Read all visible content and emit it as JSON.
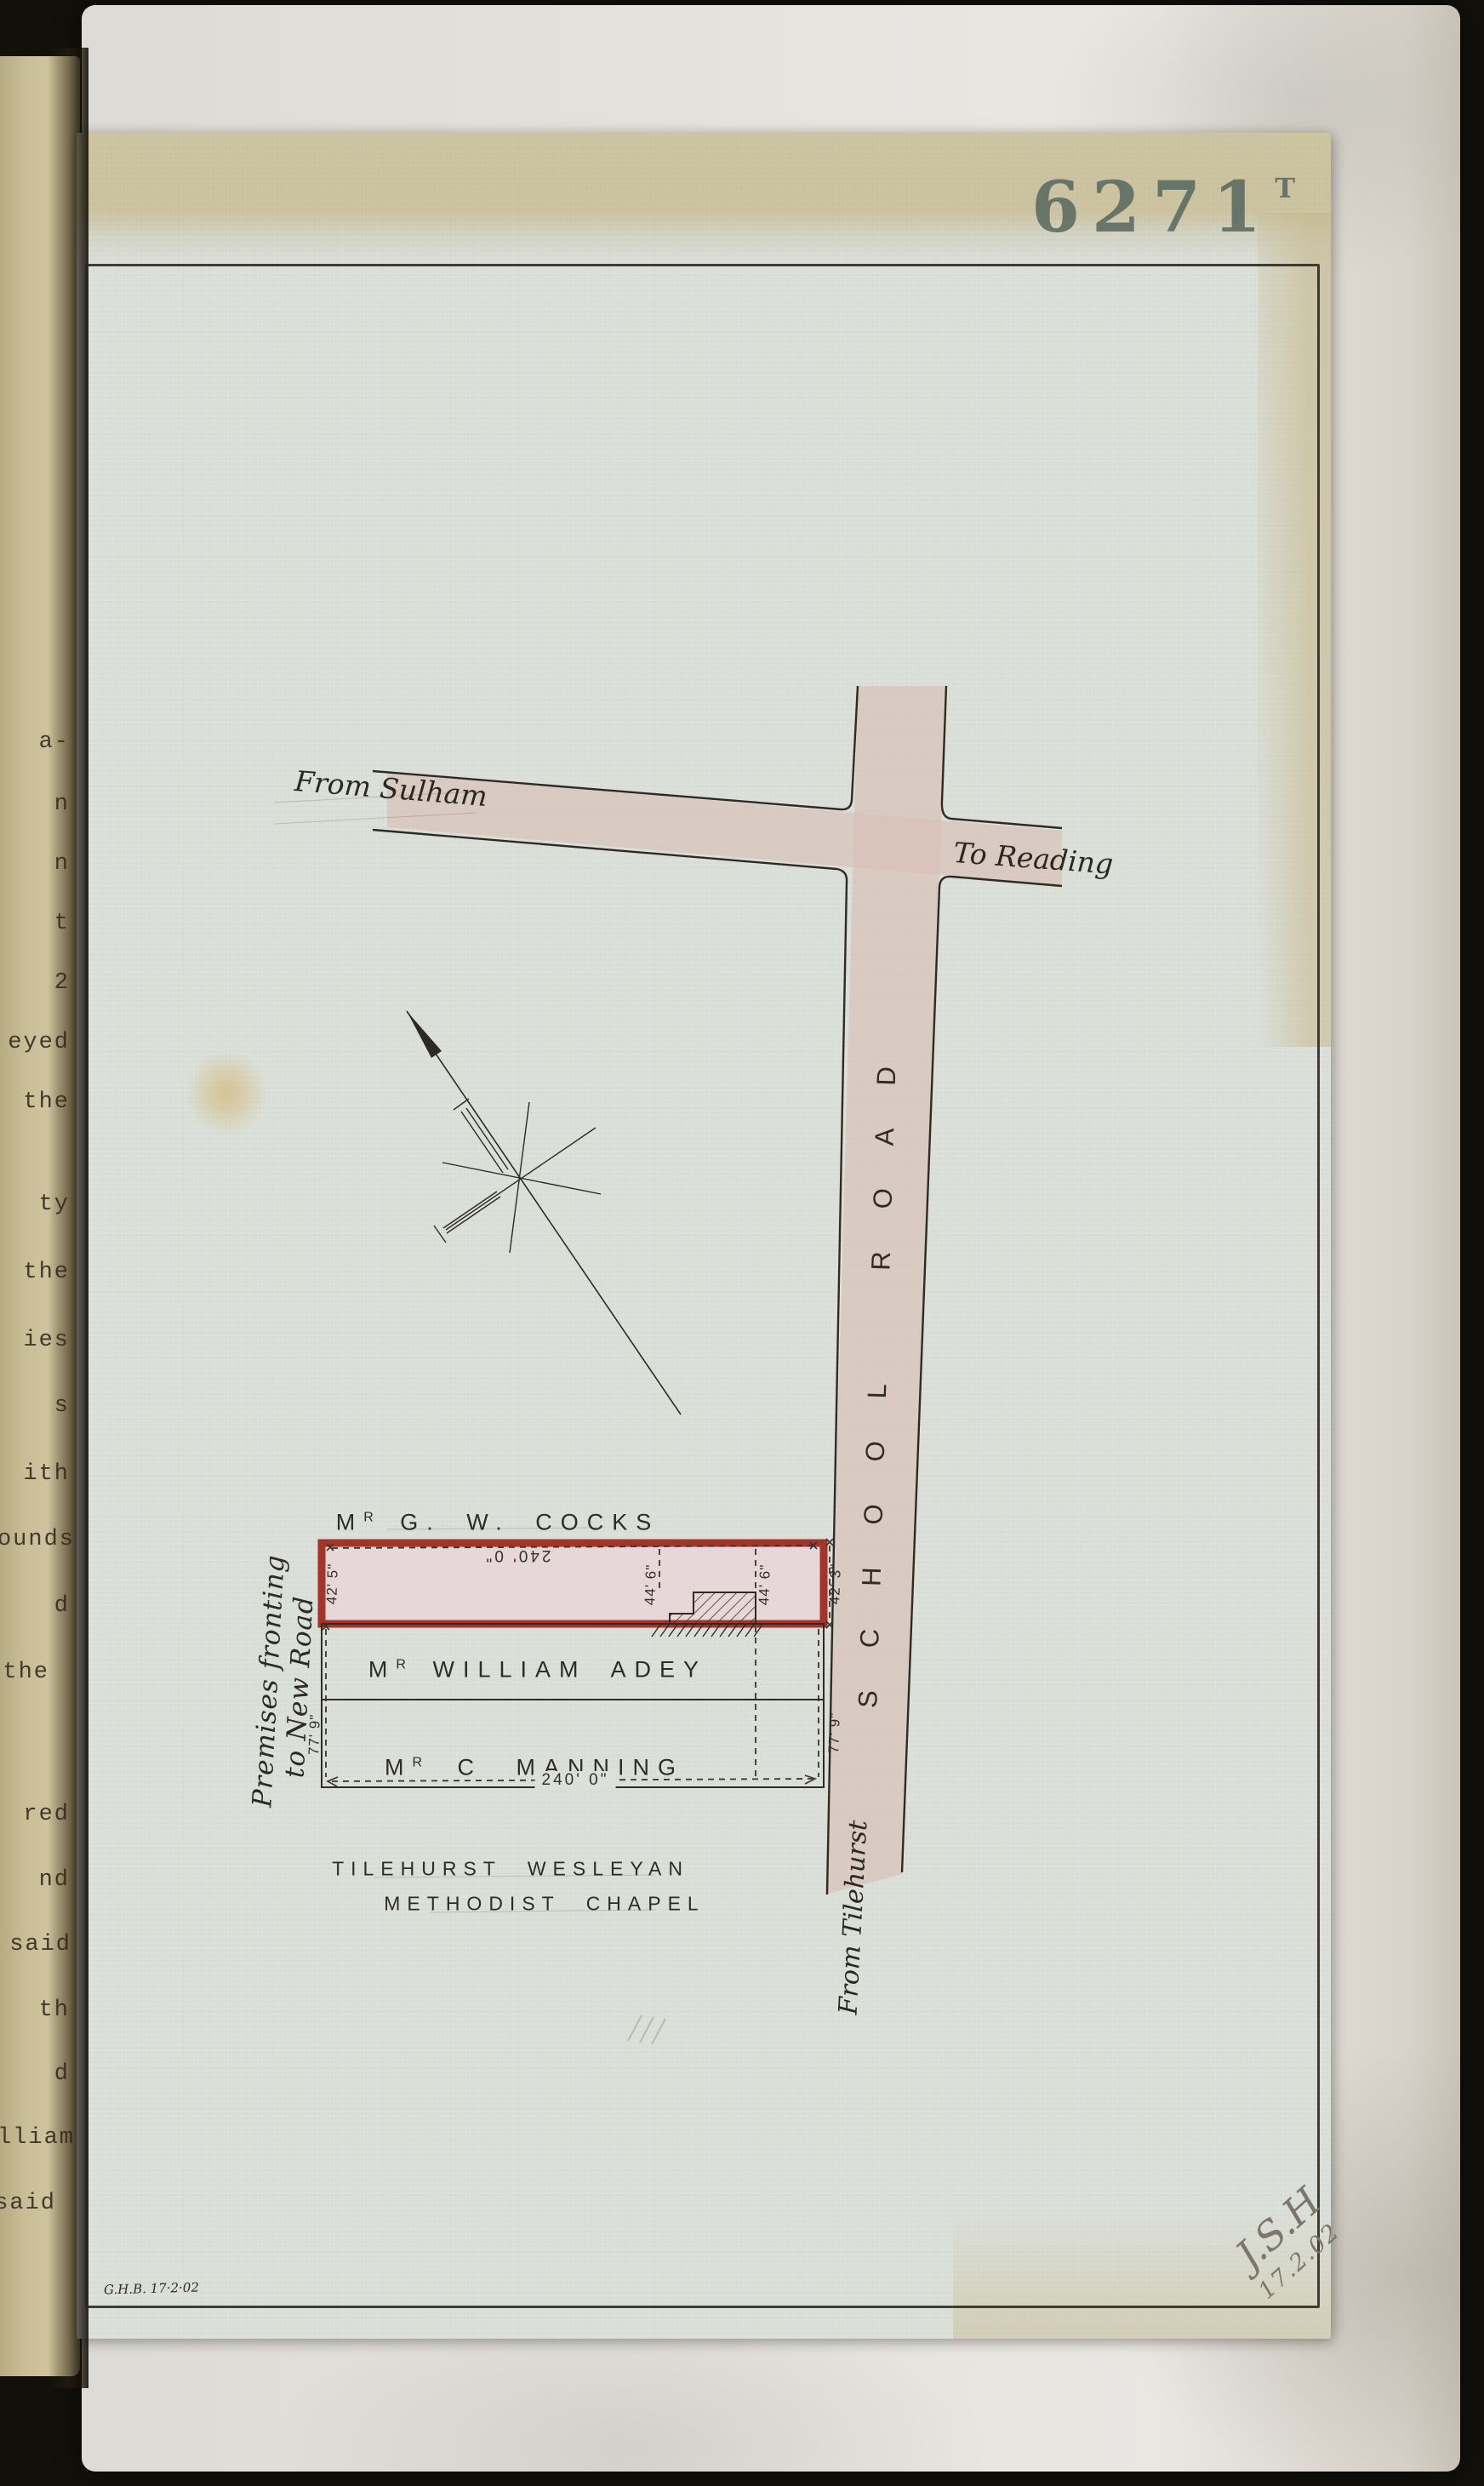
{
  "colors": {
    "background": "#12100a",
    "left_page": "#c9bd96",
    "backing_paper": "#e3e1dc",
    "plan_page": "#dce0da",
    "plan_page_top_band": "#cdc4a1",
    "road_fill": "#d8c0b8",
    "plot_red": "#a33428",
    "plot_red_fill": "#e7d7d8",
    "ink": "#33302a",
    "stamp_ink": "#5d6d64",
    "pencil": "#7d766a"
  },
  "stamp": {
    "number": "6271",
    "suffix": "T"
  },
  "left_page_fragments": [
    "a-",
    "n",
    "n",
    "t",
    "2",
    "eyed",
    "the",
    "ty",
    "the",
    "ies",
    "s",
    "ith",
    "ounds",
    "d",
    "the",
    "red",
    "nd",
    "said",
    "th",
    "d",
    "illiam",
    "said"
  ],
  "map": {
    "roads": {
      "from_sulham": "From Sulham",
      "to_reading": "To Reading",
      "school_road": "SCHOOL ROAD",
      "from_tilehurst": "From Tilehurst"
    },
    "plots": [
      {
        "title": "M",
        "title_sup": "R",
        "name": "G. W. COCKS"
      },
      {
        "title": "M",
        "title_sup": "R",
        "name": "WILLIAM ADEY"
      },
      {
        "title": "M",
        "title_sup": "R",
        "name": "C MANNING"
      }
    ],
    "dimensions": {
      "frontage_top": "240' 0\"",
      "frontage_bottom": "240' 0\"",
      "plot_left": "42' 5\"",
      "plot_right": "42' 3\"",
      "building_left": "44' 6\"",
      "building_right": "44' 6\"",
      "depth_left": "77' 9\"",
      "depth_right": "77' 9\""
    },
    "premises_note": {
      "line1": "Premises fronting",
      "line2": "to New Road"
    },
    "chapel": {
      "line1": "TILEHURST WESLEYAN",
      "line2": "METHODIST CHAPEL"
    },
    "surveyor_note": "G.H.B. 17·2·02",
    "signature": {
      "initials": "J.S.H",
      "date": "17.2.02"
    }
  }
}
